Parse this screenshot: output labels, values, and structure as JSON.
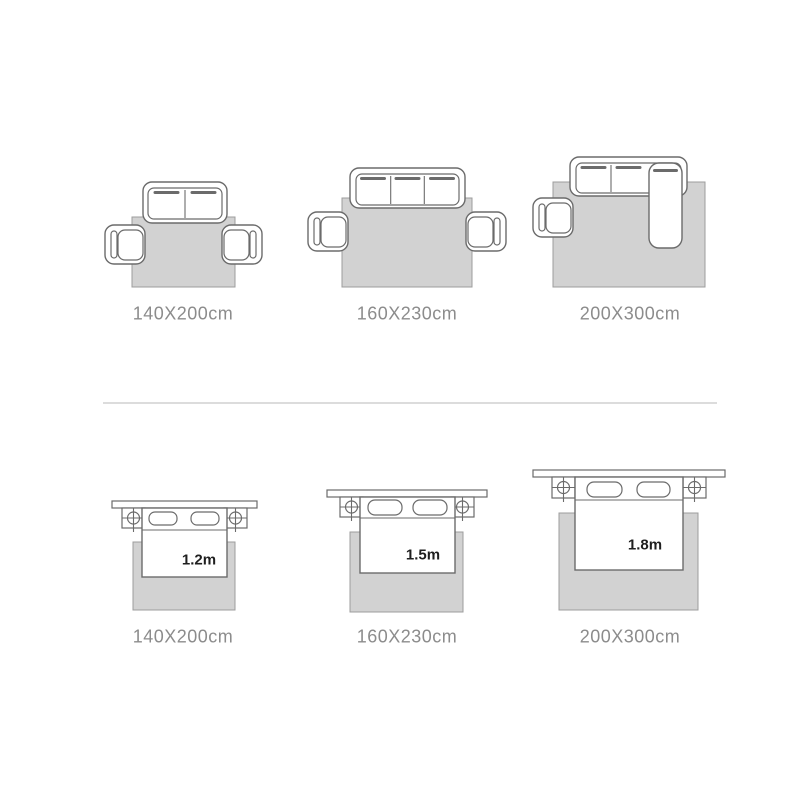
{
  "colors": {
    "background": "#ffffff",
    "outline": "#6b6b6b",
    "rug_fill": "#d2d2d2",
    "rug_stroke": "#9c9c9c",
    "label_color": "#8c8c8c",
    "bed_size_color": "#1f1f1f",
    "divider_color": "#dcdcdc"
  },
  "living_room_row": {
    "diagrams": [
      {
        "label": "140X200cm"
      },
      {
        "label": "160X230cm"
      },
      {
        "label": "200X300cm"
      }
    ]
  },
  "bedroom_row": {
    "diagrams": [
      {
        "label": "140X200cm",
        "bed_size": "1.2m"
      },
      {
        "label": "160X230cm",
        "bed_size": "1.5m"
      },
      {
        "label": "200X300cm",
        "bed_size": "1.8m"
      }
    ]
  }
}
